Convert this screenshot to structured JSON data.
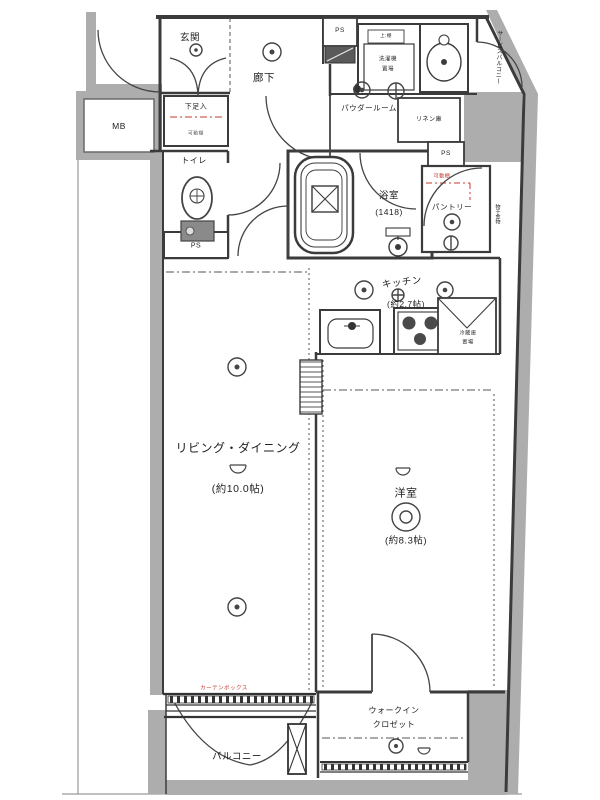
{
  "title": "間取り図 (1LDK floor plan)",
  "colors": {
    "wall_fill": "#adadad",
    "line": "#3b3b3b",
    "accent_red": "#c0392b",
    "background": "#ffffff"
  },
  "plan": {
    "genkan": "玄関",
    "rouka": "廊下",
    "powder": "パウダールーム",
    "bath": "浴室",
    "bath_size": "(1418)",
    "toilet": "トイレ",
    "mb": "MB",
    "ps": "PS",
    "shoe": "下足入",
    "shoe_shelf": "可動棚",
    "laundry_top": "上:棚",
    "laundry1": "洗濯機",
    "laundry2": "置場",
    "linen": "リネン庫",
    "pantry": "パントリー",
    "pantry_shelf": "可動棚",
    "service_balcony": "サービスバルコニー",
    "pole": "物干金物",
    "kitchen": "キッチン",
    "kitchen_size": "(約2.7帖)",
    "fridge1": "冷蔵庫",
    "fridge2": "置場",
    "living": "リビング・ダイニング",
    "living_size": "(約10.0帖)",
    "bedroom": "洋室",
    "bedroom_size": "(約8.3帖)",
    "wic1": "ウォークイン",
    "wic2": "クロゼット",
    "balcony": "バルコニー",
    "curtain": "カーテンボックス"
  }
}
